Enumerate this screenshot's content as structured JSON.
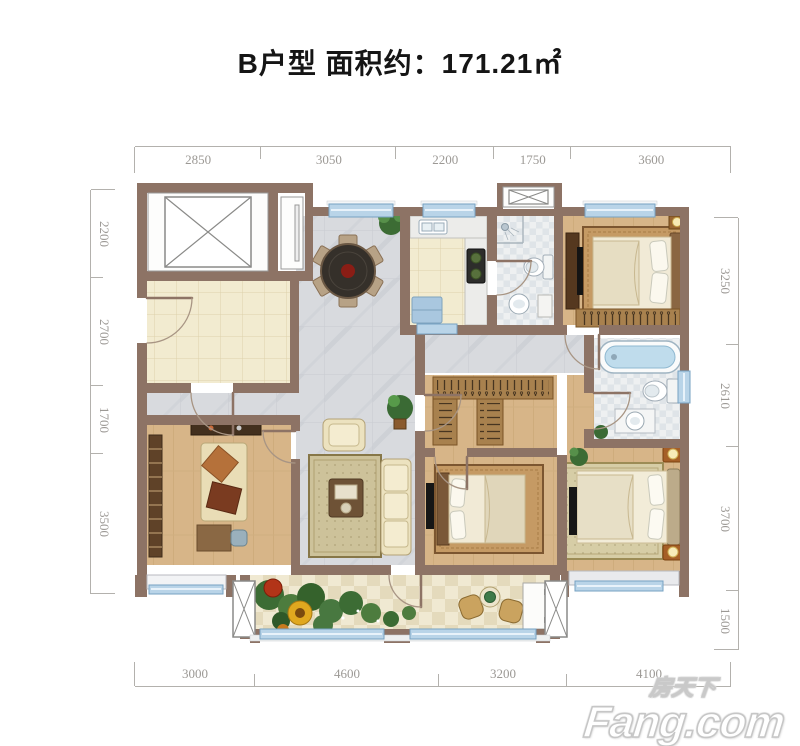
{
  "title": {
    "text": "B户型 面积约：171.21㎡"
  },
  "dimensions": {
    "top": [
      "2850",
      "3050",
      "2200",
      "1750",
      "3600"
    ],
    "bottom": [
      "3000",
      "4600",
      "3200",
      "4100"
    ],
    "left": [
      "2200",
      "2700",
      "1700",
      "3500"
    ],
    "right": [
      "3250",
      "2610",
      "3700",
      "1500"
    ]
  },
  "watermark": {
    "cn": "房天下",
    "en": "Fang.com"
  },
  "icons": [
    "elevator-shaft-icon",
    "vent-shaft-icon",
    "column-icon",
    "door-arc-icon",
    "window-icon"
  ],
  "colors": {
    "wall_brown": "#8d7365",
    "window_blue": "#b9d4e8",
    "wood_floor": "#d7b588",
    "foyer_tile": "#f2ebd0",
    "marble_gray": "#d8dade",
    "bath_tile": "#eef0f1",
    "title_text": "#151515",
    "dimension_text": "#9c9995",
    "watermark_outline": "#c6c6c6"
  }
}
